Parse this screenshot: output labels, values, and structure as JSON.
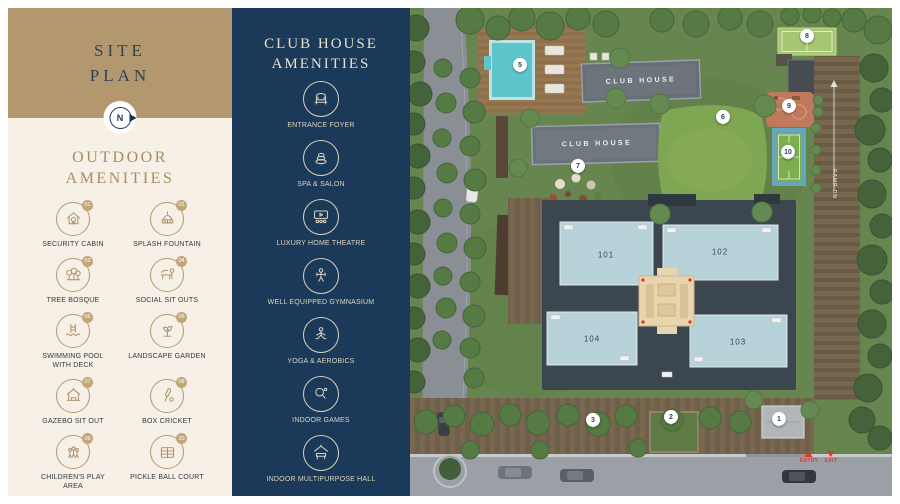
{
  "left_panel": {
    "title": "SITE PLAN",
    "compass_letter": "N",
    "outdoor": {
      "heading": "OUTDOOR AMENITIES",
      "items": [
        {
          "num": "01",
          "label": "SECURITY CABIN",
          "icon": "security-cabin-icon"
        },
        {
          "num": "02",
          "label": "SPLASH FOUNTAIN",
          "icon": "splash-fountain-icon"
        },
        {
          "num": "03",
          "label": "TREE BOSQUE",
          "icon": "tree-bosque-icon"
        },
        {
          "num": "04",
          "label": "SOCIAL SIT OUTS",
          "icon": "social-sit-outs-icon"
        },
        {
          "num": "05",
          "label": "SWIMMING POOL WITH DECK",
          "icon": "swimming-pool-icon"
        },
        {
          "num": "06",
          "label": "LANDSCAPE GARDEN",
          "icon": "landscape-garden-icon"
        },
        {
          "num": "07",
          "label": "GAZEBO SIT OUT",
          "icon": "gazebo-icon"
        },
        {
          "num": "08",
          "label": "BOX CRICKET",
          "icon": "box-cricket-icon"
        },
        {
          "num": "09",
          "label": "CHILDREN'S PLAY AREA",
          "icon": "childrens-play-icon"
        },
        {
          "num": "10",
          "label": "PICKLE BALL COURT",
          "icon": "pickle-ball-icon"
        }
      ]
    }
  },
  "club_panel": {
    "heading": "CLUB HOUSE AMENITIES",
    "items": [
      {
        "label": "ENTRANCE FOYER",
        "icon": "entrance-foyer-icon"
      },
      {
        "label": "SPA & SALON",
        "icon": "spa-salon-icon"
      },
      {
        "label": "LUXURY HOME THEATRE",
        "icon": "home-theatre-icon"
      },
      {
        "label": "WELL EQUIPPED GYMNASIUM",
        "icon": "gymnasium-icon"
      },
      {
        "label": "YOGA & AEROBICS",
        "icon": "yoga-icon"
      },
      {
        "label": "INDOOR GAMES",
        "icon": "indoor-games-icon"
      },
      {
        "label": "INDOOR MULTIPURPOSE HALL",
        "icon": "multipurpose-hall-icon"
      }
    ]
  },
  "siteplan": {
    "buildings": [
      {
        "label": "CLUB HOUSE",
        "x": 231,
        "y": 73,
        "rot": -2
      },
      {
        "label": "CLUB HOUSE",
        "x": 187,
        "y": 136,
        "rot": -1.5
      }
    ],
    "towers": [
      {
        "num": "101",
        "x": 196,
        "y": 247
      },
      {
        "num": "102",
        "x": 310,
        "y": 244
      },
      {
        "num": "104",
        "x": 182,
        "y": 331
      },
      {
        "num": "103",
        "x": 328,
        "y": 334
      }
    ],
    "markers": [
      {
        "num": "1",
        "x": 369,
        "y": 420
      },
      {
        "num": "2",
        "x": 261,
        "y": 418
      },
      {
        "num": "3",
        "x": 183,
        "y": 421
      },
      {
        "num": "5",
        "x": 110,
        "y": 66
      },
      {
        "num": "6",
        "x": 313,
        "y": 118
      },
      {
        "num": "7",
        "x": 168,
        "y": 167
      },
      {
        "num": "8",
        "x": 397,
        "y": 37
      },
      {
        "num": "9",
        "x": 379,
        "y": 107
      },
      {
        "num": "10",
        "x": 378,
        "y": 153
      }
    ],
    "gates": {
      "entry": {
        "label": "ENTRY",
        "x": 399,
        "y": 443
      },
      "exit": {
        "label": "EXIT",
        "x": 421,
        "y": 443
      }
    },
    "ramp": {
      "label": "RAMP DN",
      "x": 424,
      "y": 176
    }
  },
  "colors": {
    "gold": "#b3986f",
    "cream": "#f6f0e6",
    "navy": "#1b3a59",
    "icon_tan": "#a98c63",
    "cream_text": "#ddd4be",
    "entry_red": "#d63c2f",
    "pool_cyan": "#5ec6cb",
    "tower_plate": "#b7d2d8",
    "core_beige": "#e8d5ae"
  }
}
